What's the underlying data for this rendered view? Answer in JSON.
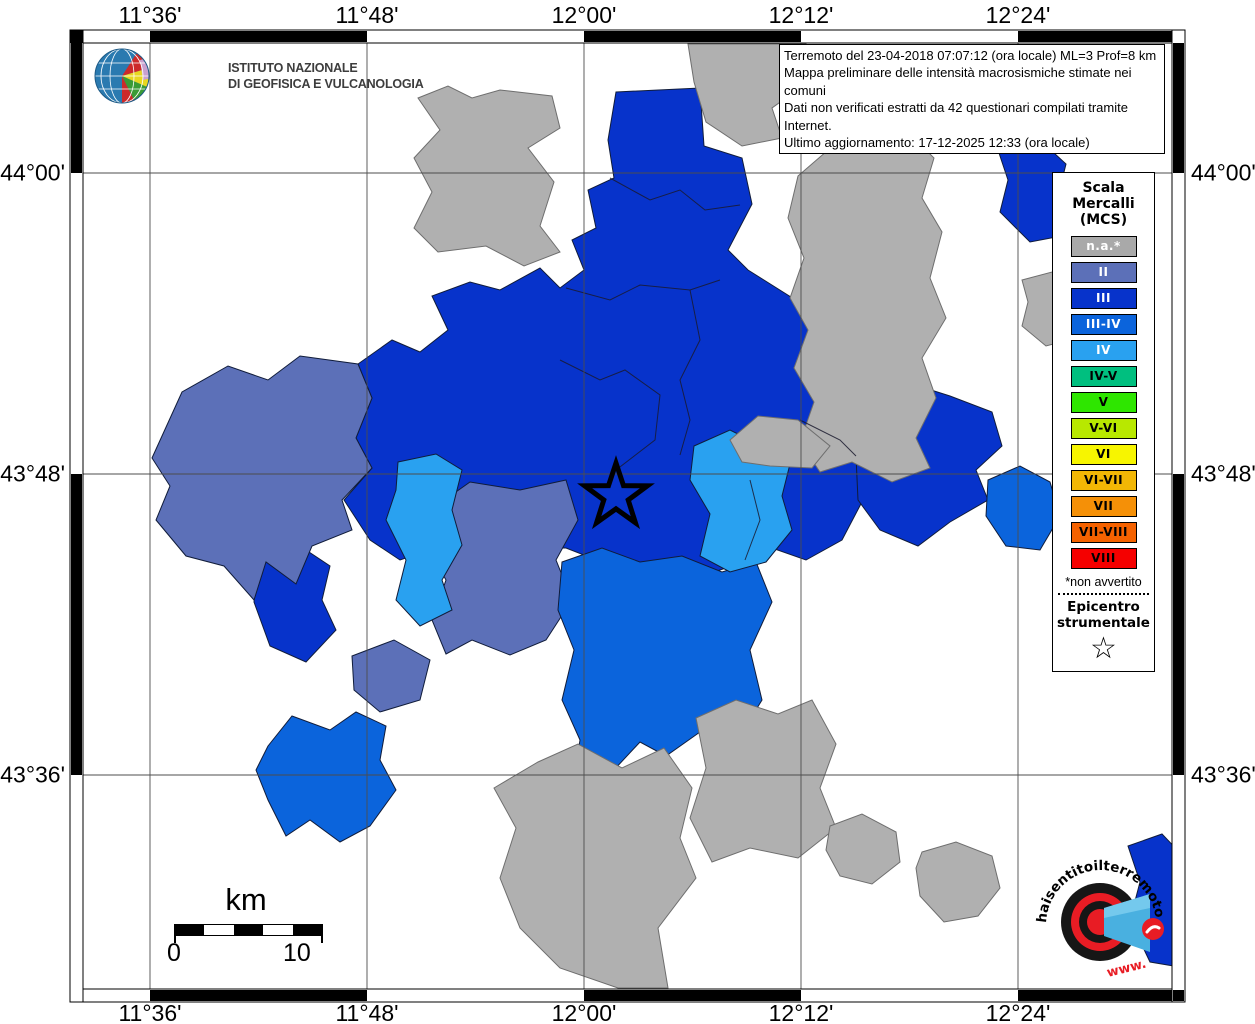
{
  "header": {
    "ingv_name": "ISTITUTO NAZIONALE\nDI GEOFISICA E VULCANOLOGIA"
  },
  "info_box": {
    "line1": "Terremoto del 23-04-2018 07:07:12 (ora locale) ML=3 Prof=8 km",
    "line2": "Mappa preliminare delle intensità macrosismiche stimate nei comuni",
    "line3": "Dati non verificati estratti da 42 questionari compilati tramite Internet.",
    "line4": "Ultimo aggiornamento: 17-12-2025 12:33 (ora locale)"
  },
  "axes": {
    "lon": [
      {
        "label": "11°36'",
        "x": 150
      },
      {
        "label": "11°48'",
        "x": 367
      },
      {
        "label": "12°00'",
        "x": 584
      },
      {
        "label": "12°12'",
        "x": 801
      },
      {
        "label": "12°24'",
        "x": 1018
      }
    ],
    "lat": [
      {
        "label": "44°00'",
        "y": 173
      },
      {
        "label": "43°48'",
        "y": 474
      },
      {
        "label": "43°36'",
        "y": 775
      }
    ]
  },
  "legend": {
    "title": "Scala\nMercalli\n(MCS)",
    "entries": [
      {
        "label": "n.a.*",
        "color": "#a9a9a9",
        "text": "#ffffff"
      },
      {
        "label": "II",
        "color": "#5c70b8",
        "text": "#ffffff"
      },
      {
        "label": "III",
        "color": "#0733cb",
        "text": "#ffffff"
      },
      {
        "label": "III-IV",
        "color": "#0b64dc",
        "text": "#ffffff"
      },
      {
        "label": "IV",
        "color": "#29a1f0",
        "text": "#ffffff"
      },
      {
        "label": "IV-V",
        "color": "#00bf7f",
        "text": "#000000"
      },
      {
        "label": "V",
        "color": "#2ee600",
        "text": "#000000"
      },
      {
        "label": "V-VI",
        "color": "#b8e800",
        "text": "#000000"
      },
      {
        "label": "VI",
        "color": "#f7f500",
        "text": "#000000"
      },
      {
        "label": "VI-VII",
        "color": "#f2b705",
        "text": "#000000"
      },
      {
        "label": "VII",
        "color": "#f59007",
        "text": "#000000"
      },
      {
        "label": "VII-VIII",
        "color": "#f56200",
        "text": "#000000"
      },
      {
        "label": "VIII",
        "color": "#f50000",
        "text": "#000000"
      }
    ],
    "footnote": "*non avvertito",
    "epicenter_label": "Epicentro\nstrumentale",
    "epicenter_symbol": "☆"
  },
  "scale_bar": {
    "unit": "km",
    "start": "0",
    "end": "10"
  },
  "watermark": {
    "arc_text": "haisentitoilterremoto",
    "arc_text_red": ".it",
    "www_text": "www."
  },
  "map": {
    "background": "#ffffff",
    "grid_color": "#4d4d4d",
    "frame": {
      "outer": [
        70,
        30,
        1185,
        1002
      ],
      "inner": [
        83,
        43,
        1172,
        989
      ]
    },
    "palette": {
      "na": "#b0b0b0",
      "II": "#5c70b8",
      "III": "#0733cb",
      "III-IV": "#0b64dc",
      "IV": "#29a1f0"
    },
    "stroke_colors": {
      "na": "#6e6e6e",
      "blue": "#101c3a"
    },
    "epicenter": {
      "x": 616,
      "y": 496
    },
    "regions": [
      {
        "name": "region-central",
        "level": "III",
        "points": "616,92 700,88 704,146 742,158 752,204 728,250 748,270 802,304 836,344 872,384 858,440 864,498 842,540 806,560 772,548 744,562 702,576 660,560 632,588 602,562 566,548 520,548 470,560 436,548 400,560 370,540 344,500 372,468 356,438 372,398 358,364 392,340 420,352 448,330 432,296 470,282 500,290 540,268 560,288 584,270 572,240 596,228 588,190 614,178 608,140"
      },
      {
        "name": "region-east",
        "level": "III",
        "points": "856,456 874,406 906,382 950,396 992,412 1002,446 976,470 988,500 950,522 918,546 880,530 858,500"
      },
      {
        "name": "region-northeast",
        "level": "III",
        "points": "998,150 1040,140 1066,164 1056,204 1072,234 1030,242 1000,212 1008,180"
      },
      {
        "name": "region-west-small",
        "level": "III",
        "points": "258,556 300,546 330,566 322,600 336,630 306,662 270,646 254,602"
      },
      {
        "name": "region-corner-se",
        "level": "III",
        "points": "1128,846 1162,834 1185,858 1185,968 1150,962 1130,920 1140,882"
      },
      {
        "name": "region-left-big",
        "level": "II",
        "points": "152,458 182,392 228,366 268,380 300,356 358,364 372,398 356,438 372,468 342,500 352,530 312,546 296,584 266,562 254,600 224,566 186,556 156,520 170,486"
      },
      {
        "name": "region-center-slate",
        "level": "II",
        "points": "436,506 470,482 520,490 566,480 578,520 556,560 572,600 546,640 510,655 472,640 446,654 432,620 446,580 426,544"
      },
      {
        "name": "region-slate-small",
        "level": "II",
        "points": "352,656 394,640 430,660 420,700 380,712 354,690"
      },
      {
        "name": "region-sw-isolated",
        "level": "III-IV",
        "points": "268,746 292,716 330,730 356,712 386,726 380,760 396,790 370,826 340,842 310,820 286,836 268,800 256,770"
      },
      {
        "name": "region-south-center",
        "level": "III-IV",
        "points": "562,562 602,548 640,562 682,556 722,572 756,562 772,602 750,650 762,700 736,742 700,732 666,756 640,742 612,772 600,806 572,790 580,740 562,700 574,650 558,610"
      },
      {
        "name": "region-east-mid",
        "level": "III-IV",
        "points": "988,480 1020,466 1050,482 1060,516 1040,550 1006,546 986,516"
      },
      {
        "name": "region-band-light",
        "level": "IV",
        "points": "398,462 436,454 462,470 452,510 462,545 442,580 452,610 420,626 396,600 406,560 386,520 396,490"
      },
      {
        "name": "region-light-east",
        "level": "IV",
        "points": "694,446 730,430 762,446 792,456 782,496 792,530 766,562 730,572 700,556 710,514 690,480"
      },
      {
        "name": "region-gray-nw",
        "level": "na",
        "points": "418,98 448,86 472,98 500,90 552,96 560,128 528,148 554,182 540,226 560,252 524,266 486,246 438,252 414,228 432,192 414,158 440,130"
      },
      {
        "name": "region-gray-top",
        "level": "na",
        "points": "688,44 806,44 800,88 772,108 782,138 742,146 706,122 694,82"
      },
      {
        "name": "region-gray-top2",
        "level": "na",
        "points": "826,78 868,54 918,68 932,108 892,132 844,122"
      },
      {
        "name": "region-gray-right-big",
        "level": "na",
        "points": "798,176 842,138 884,148 908,132 934,158 922,198 942,232 930,278 946,318 922,358 936,398 916,438 930,468 892,482 852,462 820,472 800,442 814,402 794,368 808,330 790,298 804,258 788,218"
      },
      {
        "name": "region-gray-mid",
        "level": "na",
        "points": "730,440 758,416 798,420 830,446 812,468 770,466 742,462"
      },
      {
        "name": "region-gray-south-big",
        "level": "na",
        "points": "538,762 578,744 622,768 664,748 692,788 680,838 696,878 658,928 668,988 618,988 560,968 520,928 500,878 516,828 494,788"
      },
      {
        "name": "region-gray-south2",
        "level": "na",
        "points": "696,718 736,700 778,714 812,700 836,744 820,788 836,828 798,858 750,848 712,862 690,818 706,768"
      },
      {
        "name": "region-gray-s-small1",
        "level": "na",
        "points": "830,826 862,814 896,832 900,862 872,884 840,876 826,850"
      },
      {
        "name": "region-gray-s-small2",
        "level": "na",
        "points": "922,852 956,842 992,856 1000,888 978,916 944,922 920,896 916,868"
      },
      {
        "name": "region-gray-ne-small",
        "level": "na",
        "points": "1022,280 1052,272 1072,292 1064,318 1076,338 1046,346 1022,326 1028,302"
      }
    ],
    "boundary_lines": [
      {
        "points": "610,178 650,200 680,190 705,210 740,205"
      },
      {
        "points": "566,288 610,300 640,285 690,290 720,280"
      },
      {
        "points": "690,290 700,340 680,380 690,420 680,455"
      },
      {
        "points": "560,360 600,380 625,370 660,395 655,440 616,470"
      },
      {
        "points": "800,420 840,440 856,456"
      },
      {
        "points": "745,560 760,520 750,480"
      }
    ]
  }
}
